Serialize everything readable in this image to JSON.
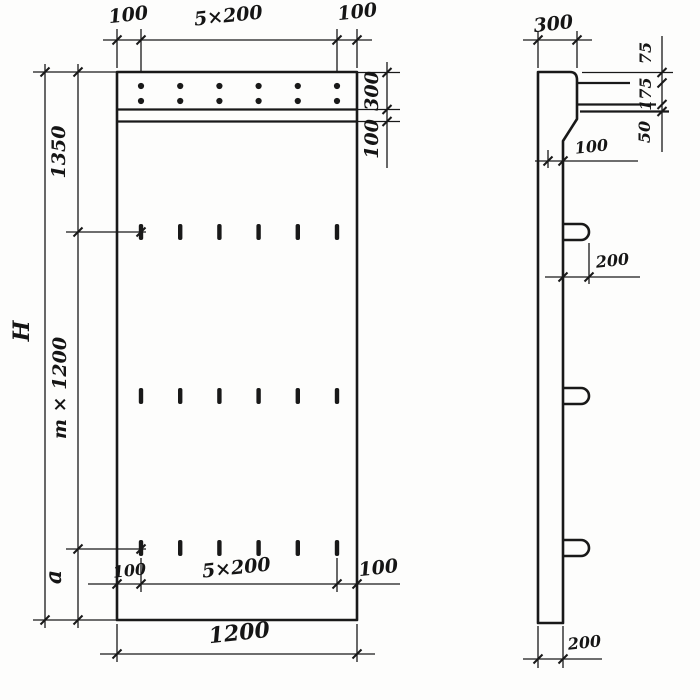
{
  "front_view": {
    "top_dim": {
      "left": "100",
      "pitch": "5×200",
      "right": "100"
    },
    "left_dims": {
      "total": "H",
      "upper": "1350",
      "middle": "m × 1200",
      "lower": "a"
    },
    "right_dims": {
      "band": "300",
      "strip": "100"
    },
    "bottom_inner_dim": {
      "left": "100",
      "pitch": "5×200",
      "right": "100"
    },
    "width_dim": "1200"
  },
  "side_view": {
    "top_dim": "300",
    "right_dims": {
      "upper": "75",
      "middle": "175",
      "lower": "50"
    },
    "step_dim": "100",
    "hook_dim": "200",
    "bottom_dim": "200"
  }
}
